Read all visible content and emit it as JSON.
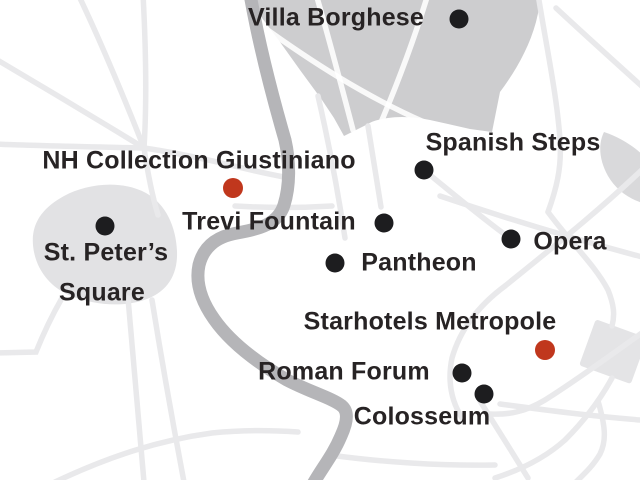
{
  "map": {
    "name": "Rome city map with hotels and attractions",
    "colors": {
      "background": "#ffffff",
      "street": "#e9e9eb",
      "street_on_park": "#ffffff",
      "park": "#cdcdcf",
      "area_light": "#e2e2e4",
      "station_block": "#e4e4e6",
      "river": "#b5b5b8",
      "attraction_dot": "#1d1d1f",
      "hotel_dot": "#c0371d",
      "label_text": "#272324"
    },
    "locations": [
      {
        "id": "villa-borghese",
        "label": "Villa Borghese",
        "type": "attraction",
        "dot": {
          "x": 459,
          "y": 19,
          "r": 9.5
        },
        "label_lines": [
          {
            "text": "Villa Borghese",
            "x": 336,
            "y": 18
          }
        ]
      },
      {
        "id": "nh-collection-giustiniano",
        "label": "NH Collection Giustiniano",
        "type": "hotel",
        "dot": {
          "x": 233,
          "y": 188,
          "r": 10
        },
        "label_lines": [
          {
            "text": "NH Collection Giustiniano",
            "x": 199,
            "y": 161
          }
        ]
      },
      {
        "id": "spanish-steps",
        "label": "Spanish Steps",
        "type": "attraction",
        "dot": {
          "x": 424,
          "y": 170,
          "r": 9.5
        },
        "label_lines": [
          {
            "text": "Spanish Steps",
            "x": 513,
            "y": 143
          }
        ]
      },
      {
        "id": "trevi-fountain",
        "label": "Trevi Fountain",
        "type": "attraction",
        "dot": {
          "x": 384,
          "y": 223,
          "r": 9.5
        },
        "label_lines": [
          {
            "text": "Trevi Fountain",
            "x": 269,
            "y": 222
          }
        ]
      },
      {
        "id": "opera",
        "label": "Opera",
        "type": "attraction",
        "dot": {
          "x": 511,
          "y": 239,
          "r": 9.5
        },
        "label_lines": [
          {
            "text": "Opera",
            "x": 570,
            "y": 242
          }
        ]
      },
      {
        "id": "pantheon",
        "label": "Pantheon",
        "type": "attraction",
        "dot": {
          "x": 335,
          "y": 263,
          "r": 9.5
        },
        "label_lines": [
          {
            "text": "Pantheon",
            "x": 419,
            "y": 263
          }
        ]
      },
      {
        "id": "st-peters-square",
        "label": "St. Peter’s Square",
        "type": "attraction",
        "dot": {
          "x": 105,
          "y": 226,
          "r": 9.5
        },
        "label_lines": [
          {
            "text": "St. Peter’s",
            "x": 106,
            "y": 253
          },
          {
            "text": "Square",
            "x": 102,
            "y": 293
          }
        ]
      },
      {
        "id": "starhotels-metropole",
        "label": "Starhotels Metropole",
        "type": "hotel",
        "dot": {
          "x": 545,
          "y": 350,
          "r": 10
        },
        "label_lines": [
          {
            "text": "Starhotels Metropole",
            "x": 430,
            "y": 322
          }
        ]
      },
      {
        "id": "roman-forum",
        "label": "Roman Forum",
        "type": "attraction",
        "dot": {
          "x": 462,
          "y": 373,
          "r": 9.5
        },
        "label_lines": [
          {
            "text": "Roman Forum",
            "x": 344,
            "y": 372
          }
        ]
      },
      {
        "id": "colosseum",
        "label": "Colosseum",
        "type": "attraction",
        "dot": {
          "x": 484,
          "y": 394,
          "r": 9.5
        },
        "label_lines": [
          {
            "text": "Colosseum",
            "x": 422,
            "y": 417
          }
        ]
      }
    ]
  }
}
